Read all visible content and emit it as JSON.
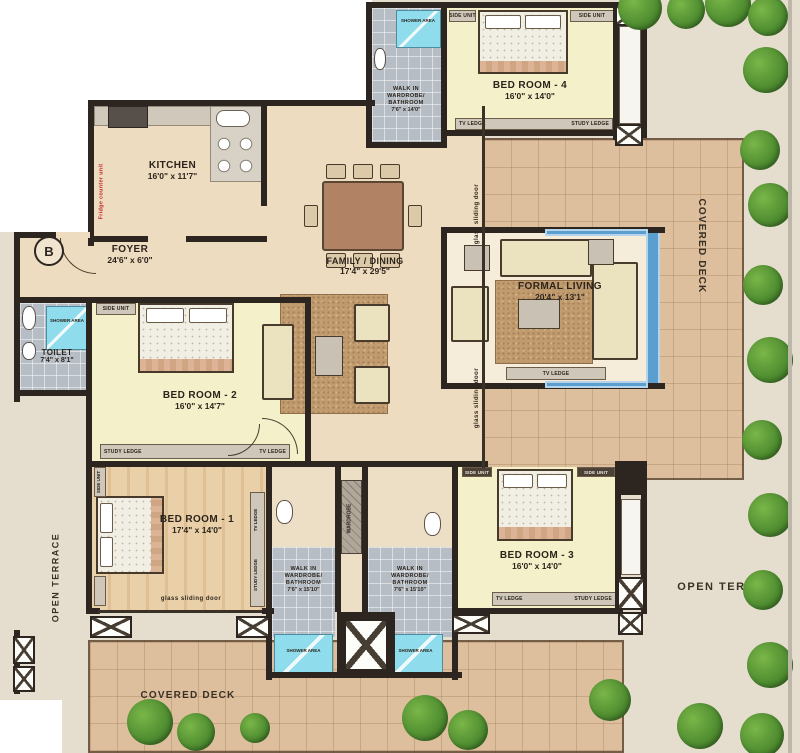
{
  "rooms": {
    "kitchen": {
      "name": "KITCHEN",
      "dims": "16'0\" x 11'7\""
    },
    "foyer": {
      "name": "FOYER",
      "dims": "24'6\" x 6'0\""
    },
    "toilet": {
      "name": "TOILET",
      "dims": "7'4\" x 8'1\""
    },
    "family_dining": {
      "name": "FAMILY / DINING",
      "dims": "17'4\" x 29'5\""
    },
    "formal_living": {
      "name": "FORMAL LIVING",
      "dims": "20'4\" x 13'1\""
    },
    "bedroom1": {
      "name": "BED ROOM - 1",
      "dims": "17'4\" x 14'0\""
    },
    "bedroom2": {
      "name": "BED ROOM - 2",
      "dims": "16'0\" x 14'7\""
    },
    "bedroom3": {
      "name": "BED ROOM - 3",
      "dims": "16'0\" x 14'0\""
    },
    "bedroom4": {
      "name": "BED ROOM - 4",
      "dims": "16'0\" x 14'0\""
    },
    "walkin4": {
      "name": "WALK IN\nWARDROBE/\nBATHROOM",
      "dims": "7'6\" x 14'0\""
    },
    "walkin1": {
      "name": "WALK IN\nWARDROBE/\nBATHROOM",
      "dims": "7'6\" x 15'10\""
    },
    "walkin3": {
      "name": "WALK IN\nWARDROBE/\nBATHROOM",
      "dims": "7'6\" x 15'10\""
    }
  },
  "outdoor": {
    "covered_deck": "COVERED DECK",
    "open_terrace": "OPEN TERRACE"
  },
  "annotations": {
    "shower_area": "SHOWER AREA",
    "side_unit": "SIDE UNIT",
    "tv_ledge": "TV LEDGE",
    "study_ledge": "STUDY LEDGE",
    "wardrobe": "WARDROBE",
    "glass_door": "glass  sliding door",
    "fridge": "Fridge  counter unit",
    "marker": "B"
  },
  "colors": {
    "wall": "#2d2620",
    "window_blue": "#5b9fd0",
    "shower_blue": "#8edcec",
    "deck": "#ddbf9e",
    "terrace": "#e5decf",
    "room_tan": "#eedcc0",
    "room_yellow": "#f4f0ca",
    "bath_gray": "#b6bdc5",
    "greenery": "#4e8c30"
  }
}
